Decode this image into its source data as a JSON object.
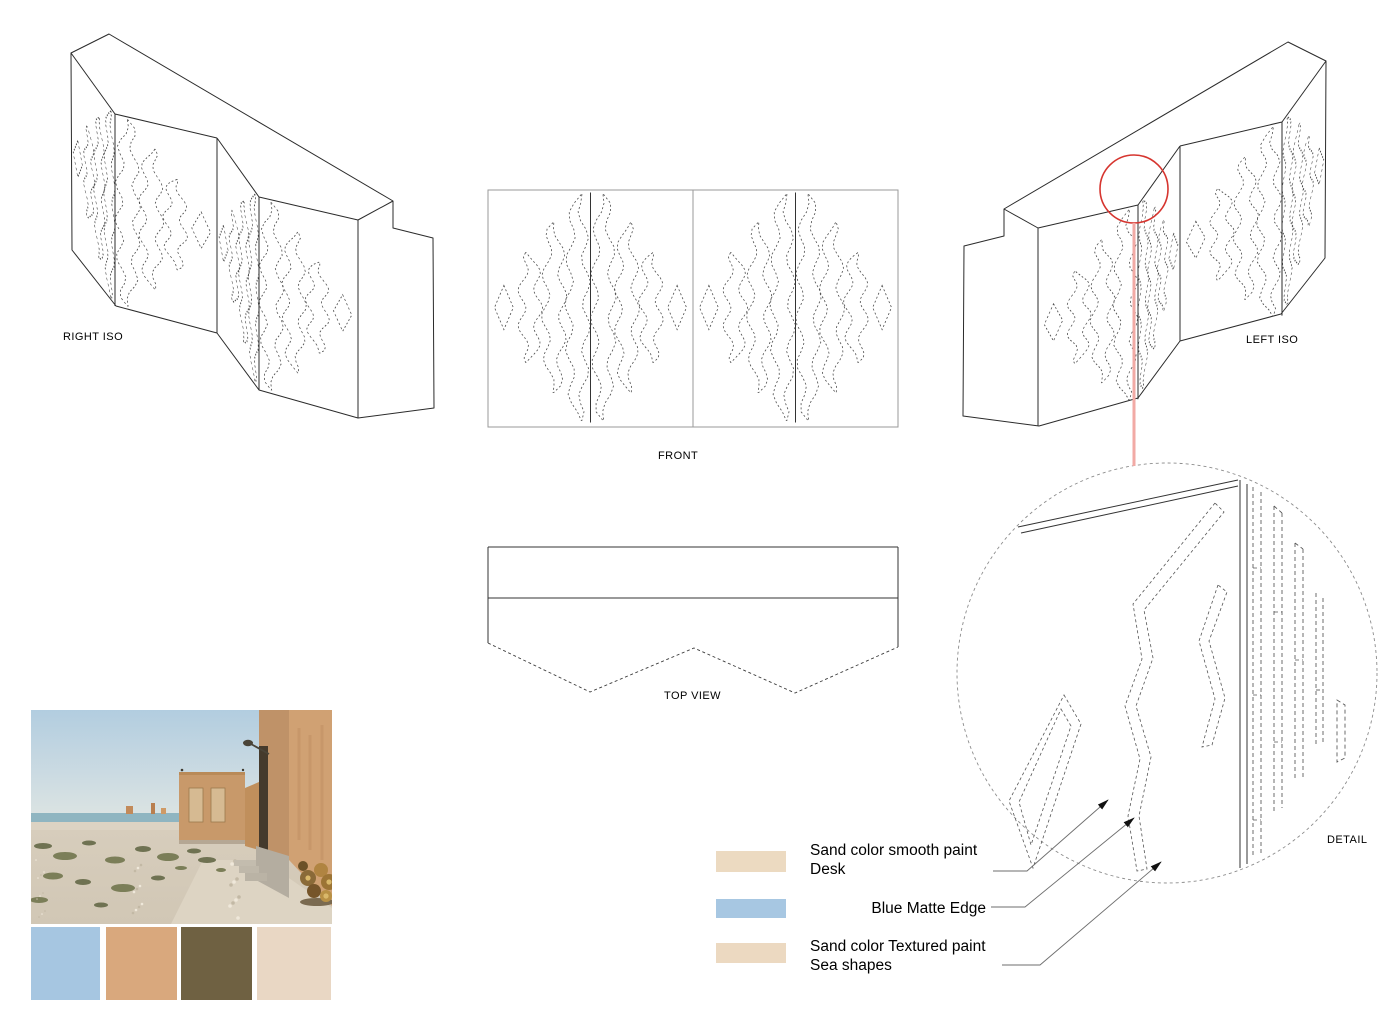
{
  "board": {
    "background": "#ffffff"
  },
  "views": {
    "right_iso": {
      "label": "RIGHT ISO"
    },
    "front": {
      "label": "FRONT"
    },
    "top": {
      "label": "TOP VIEW"
    },
    "left_iso": {
      "label": "LEFT ISO"
    },
    "detail": {
      "label": "DETAIL"
    }
  },
  "legend": {
    "items": [
      {
        "swatch_color": "#ecdac1",
        "lines": [
          "Sand color smooth paint",
          "Desk"
        ]
      },
      {
        "swatch_color": "#a7c7e2",
        "lines": [
          "Blue Matte Edge"
        ]
      },
      {
        "swatch_color": "#ecd9c1",
        "lines": [
          "Sand color Textured paint",
          "Sea shapes"
        ]
      }
    ]
  },
  "palette": {
    "swatches": [
      "#a6c6e1",
      "#d9a87d",
      "#6f6142",
      "#e9d7c4"
    ]
  },
  "annotation": {
    "detail_circle_color": "#d6352f",
    "detail_leader_color": "#f2aaa5",
    "arrow_color": "#111111"
  },
  "drawing": {
    "line_color": "#2b2b2b",
    "pattern_color": "#4c4c4c"
  }
}
